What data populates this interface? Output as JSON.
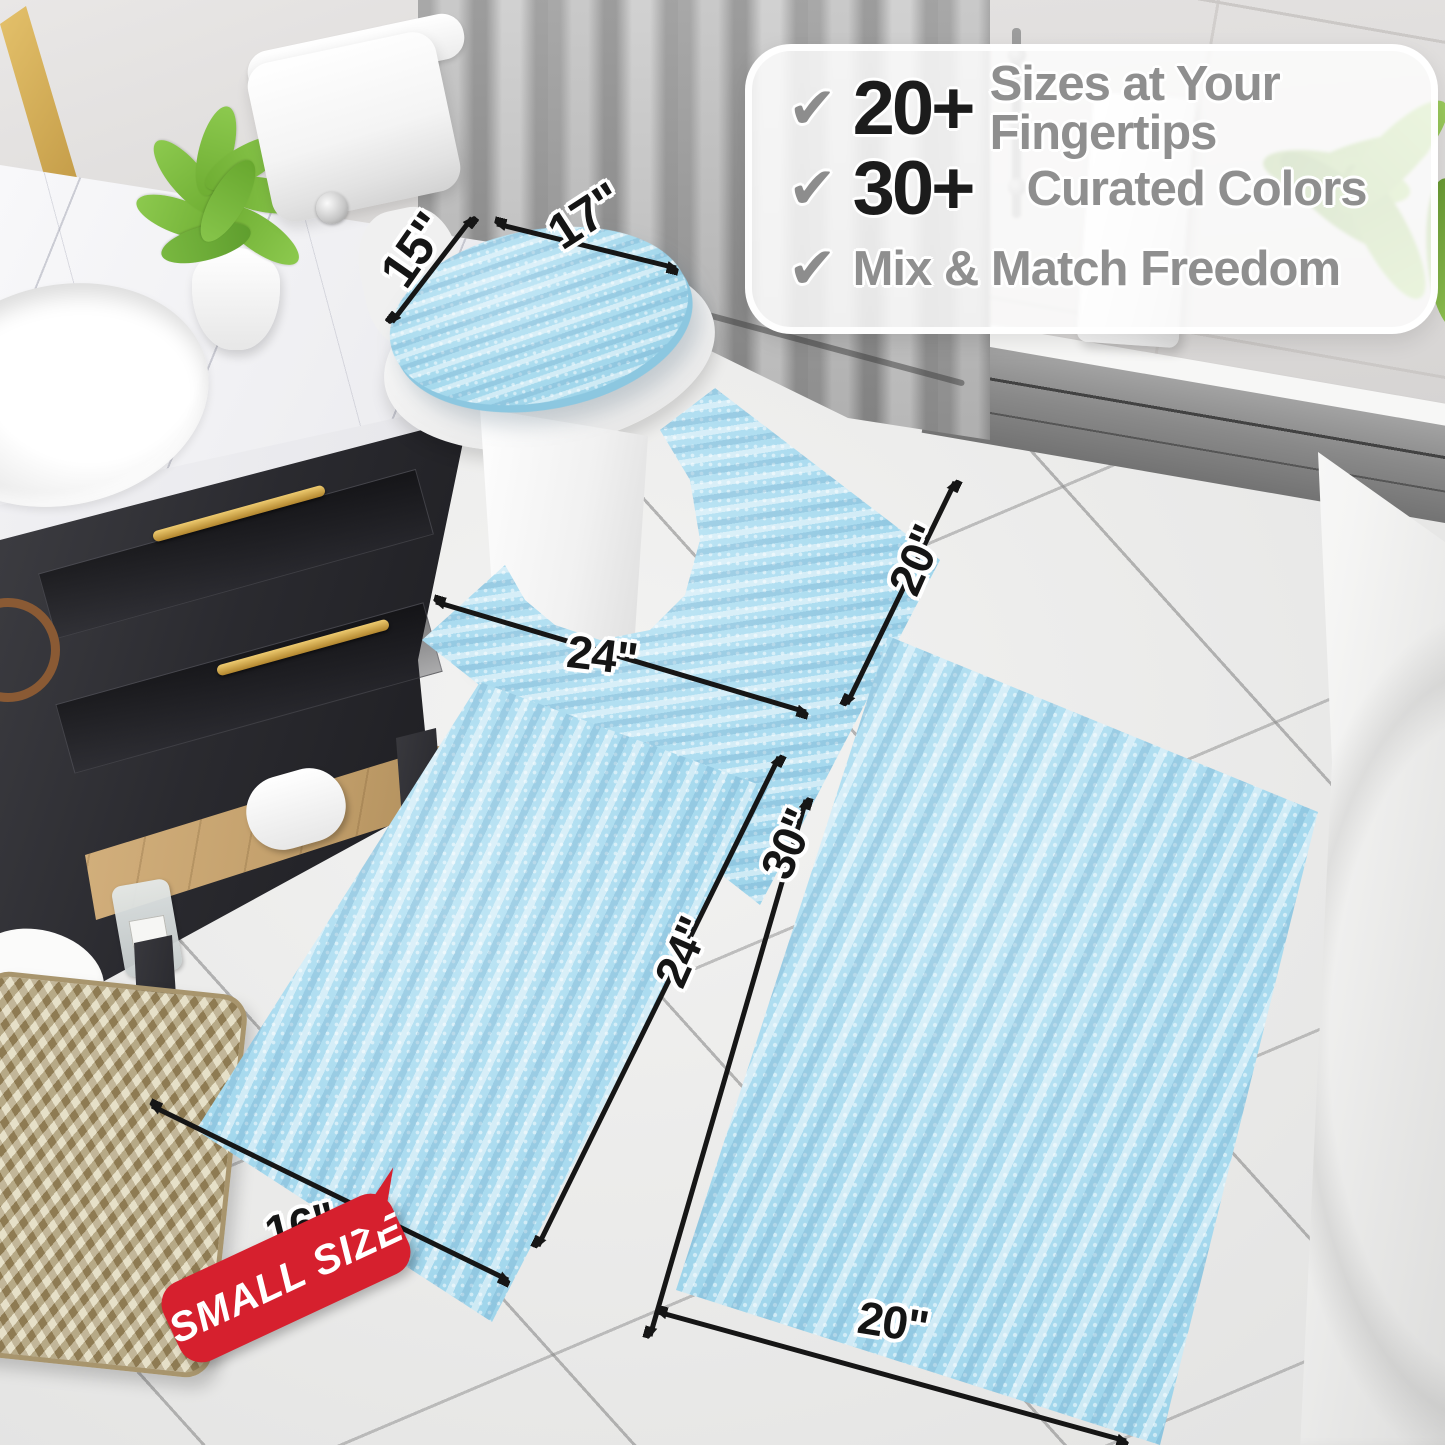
{
  "callout": {
    "check_glyph": "✔",
    "items": [
      {
        "icon": "check-icon",
        "number": "20+",
        "label": "Sizes at Your Fingertips"
      },
      {
        "icon": "check-icon",
        "number": "30+",
        "label": "Curated Colors"
      },
      {
        "icon": "check-icon",
        "number": "",
        "label": "Mix & Match Freedom"
      }
    ]
  },
  "dimensions": {
    "lid_width": "17\"",
    "lid_depth": "15\"",
    "contour_width": "24\"",
    "contour_depth": "20\"",
    "small_rug_length": "24\"",
    "small_rug_width": "16\"",
    "large_rug_length": "30\"",
    "large_rug_width": "20\""
  },
  "badge": {
    "label": "SMALL SIZE"
  },
  "colors": {
    "rug_blue": "#a6d9ee",
    "rug_backing_blue": "#8cc7e0",
    "badge_red": "#d6202e",
    "arrow_black": "#161616",
    "gold_accent": "#c9a23f"
  }
}
